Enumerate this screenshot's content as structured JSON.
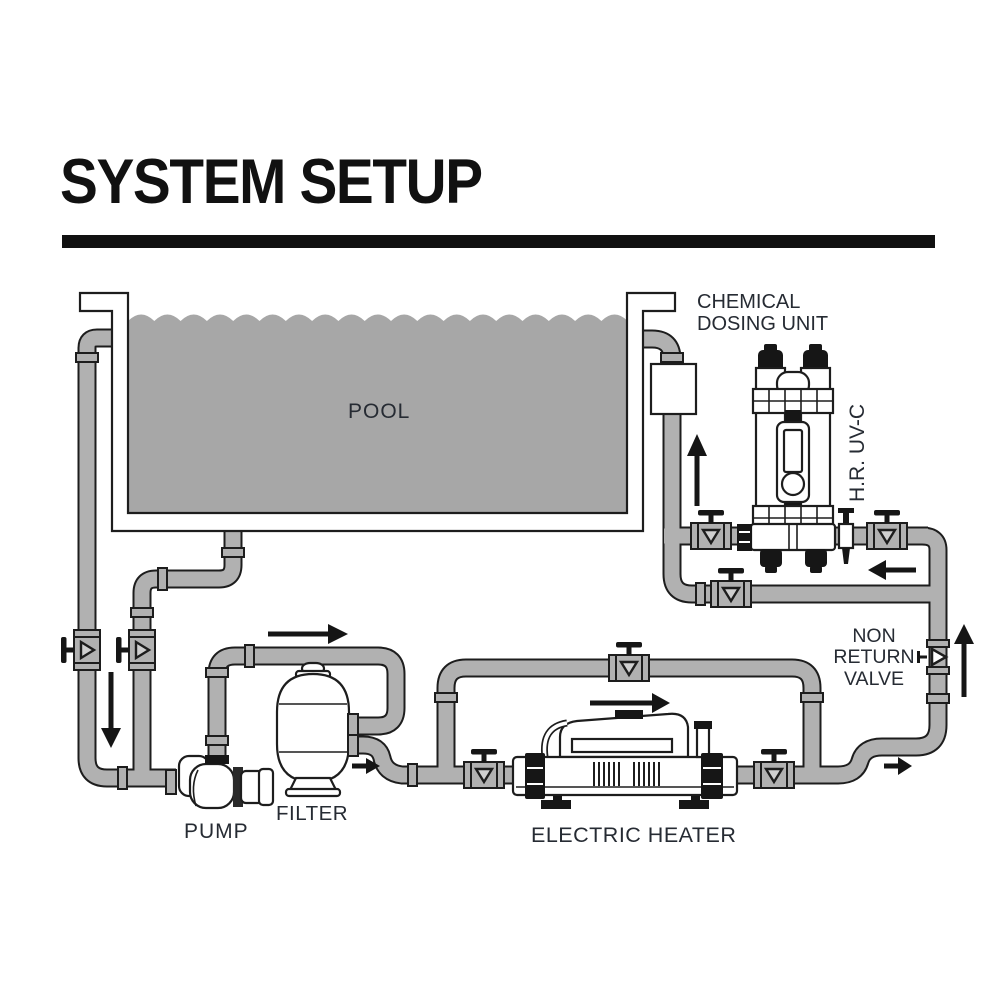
{
  "title": "SYSTEM SETUP",
  "diagram": {
    "labels": {
      "pool": "POOL",
      "chemical_dosing_unit": "CHEMICAL\nDOSING UNIT",
      "hr_uvc": "H.R. UV-C",
      "non_return_valve": "NON\nRETURN\nVALVE",
      "pump": "PUMP",
      "filter": "FILTER",
      "electric_heater": "ELECTRIC HEATER"
    },
    "components": [
      "pool",
      "pump",
      "filter",
      "electric-heater",
      "heater-bypass-line",
      "chemical-dosing-unit",
      "hr-uv-c-unit",
      "non-return-valve",
      "isolation-valves",
      "uv-bypass-line",
      "pool-drain-line",
      "skimmer-line"
    ],
    "flow_arrows": [
      {
        "id": "pool-left-outlet",
        "direction": "down"
      },
      {
        "id": "pump-to-filter",
        "direction": "right"
      },
      {
        "id": "filter-outlet",
        "direction": "right"
      },
      {
        "id": "heater-flow",
        "direction": "right"
      },
      {
        "id": "heater-outlet",
        "direction": "right"
      },
      {
        "id": "riser-to-uv",
        "direction": "up"
      },
      {
        "id": "uv-return-line",
        "direction": "left"
      },
      {
        "id": "return-to-pool",
        "direction": "up"
      }
    ],
    "colors": {
      "pipe": "#b1b1b1",
      "water": "#a7a7a7",
      "outline": "#1d1d1d",
      "label_text": "#262b33",
      "title_text": "#111111",
      "background": "#ffffff"
    }
  }
}
